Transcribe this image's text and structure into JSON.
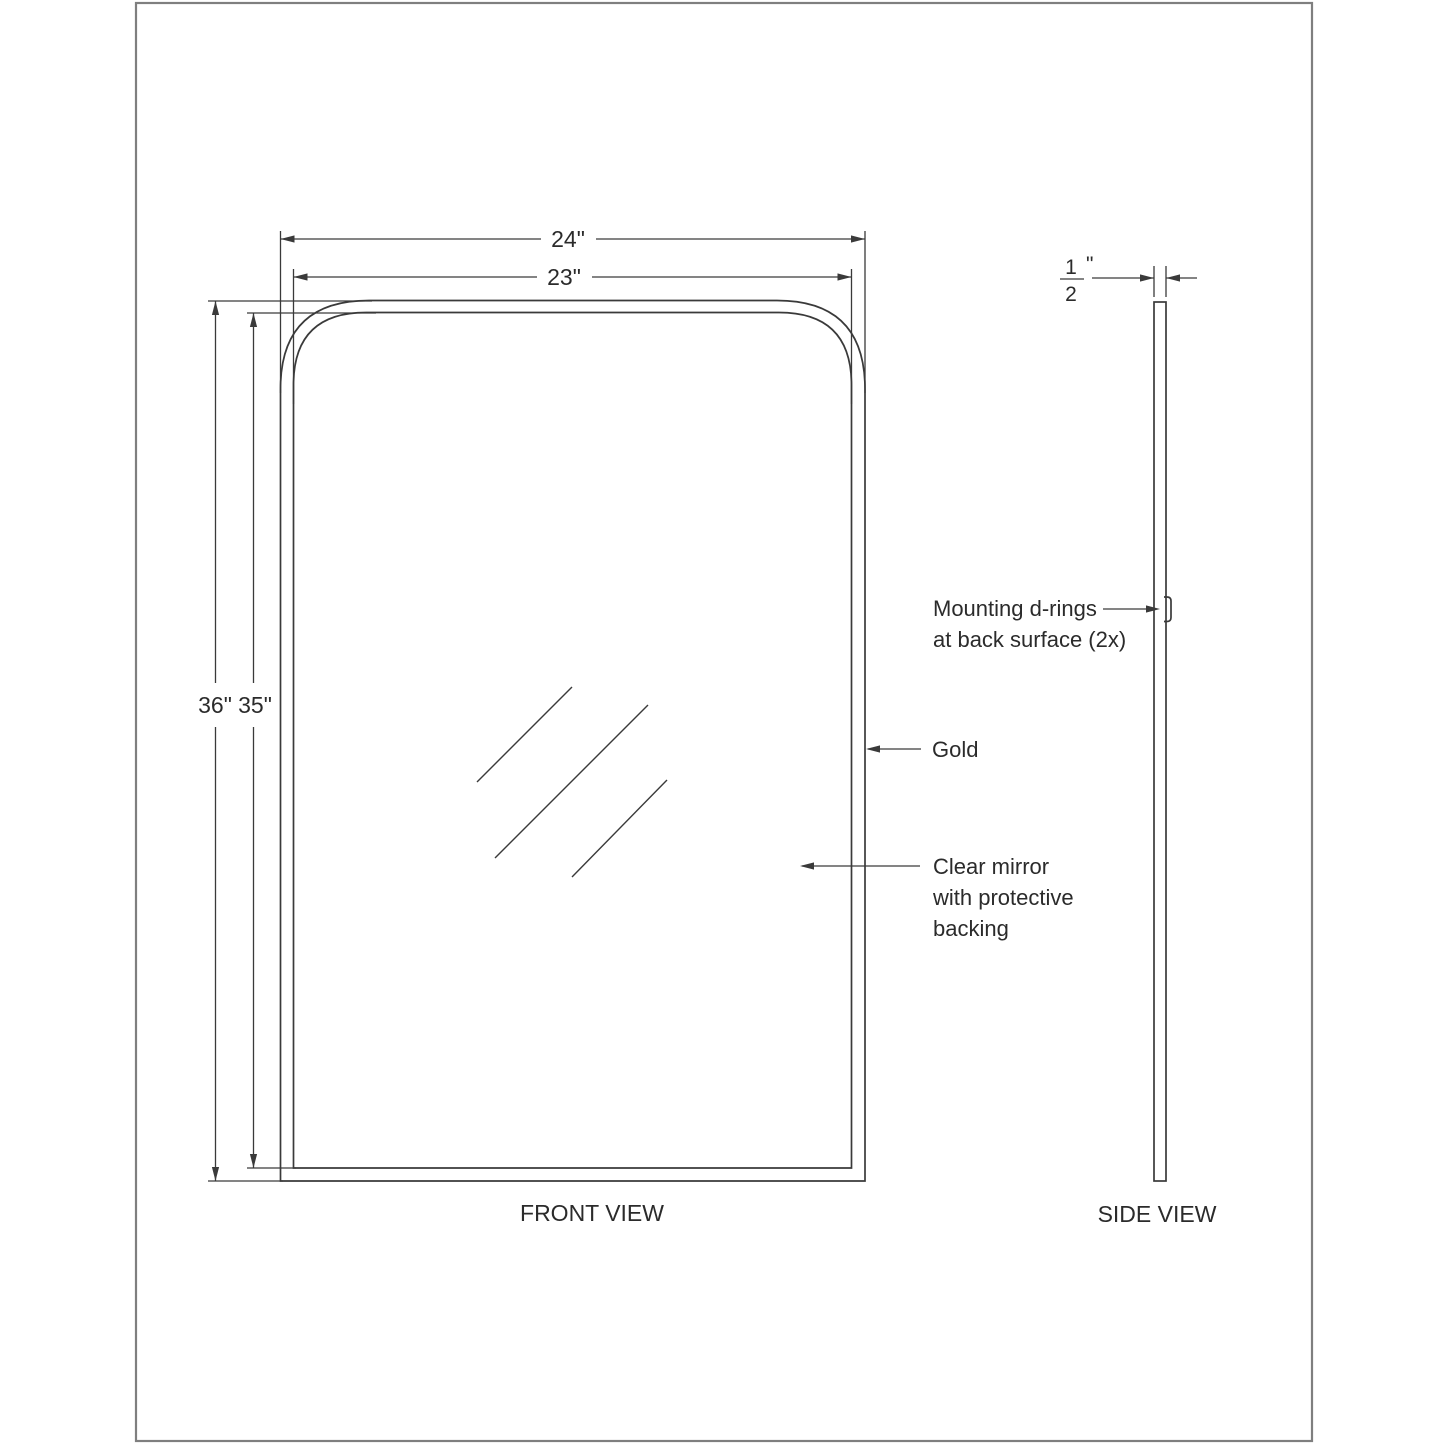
{
  "front_view": {
    "label": "FRONT VIEW",
    "outer_width": "24\"",
    "inner_width": "23\"",
    "outer_height": "36\"",
    "inner_height": "35\"",
    "frame_finish_label": "Gold",
    "mirror_note_line1": "Clear mirror",
    "mirror_note_line2": "with protective",
    "mirror_note_line3": "backing"
  },
  "side_view": {
    "label": "SIDE VIEW",
    "thickness_numerator": "1",
    "thickness_denominator": "2",
    "thickness_unit": "\"",
    "dring_note_line1": "Mounting d-rings",
    "dring_note_line2": "at back surface (2x)"
  },
  "colors": {
    "line": "#3a3a3a",
    "text": "#2b2b2b",
    "sheet_border": "#7f7f7f",
    "background": "#ffffff"
  }
}
